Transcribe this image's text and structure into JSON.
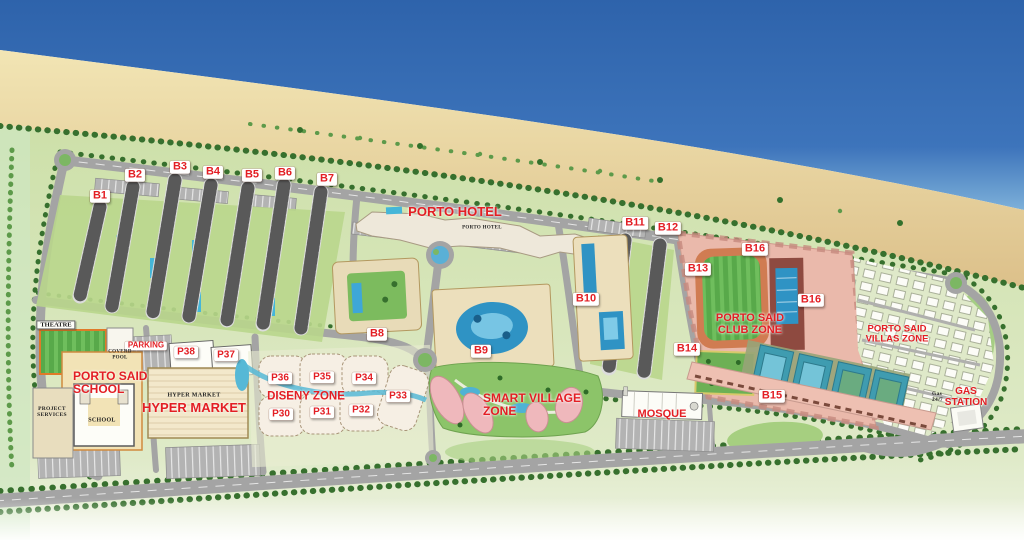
{
  "map": {
    "colors": {
      "sea_deep": "#2e63ab",
      "sea_shore": "#7db0d9",
      "sand_light": "#f2e5b4",
      "sand_dark": "#dcc08a",
      "land_green": "#cde0a9",
      "road_gray": "#a4a4a4",
      "label_red": "#e31e24",
      "chip_bg": "#ffffff",
      "pool_blue": "#2f93c4",
      "field_green": "#58a94a",
      "club_pink": "#eab9ab",
      "building_beige": "#ecdfbc",
      "tree_green": "#37702e"
    },
    "labels": [
      {
        "id": "b1",
        "style": "chip",
        "lines": [
          "B1"
        ],
        "x": 100,
        "y": 196,
        "size": 11
      },
      {
        "id": "b2",
        "style": "chip",
        "lines": [
          "B2"
        ],
        "x": 135,
        "y": 175,
        "size": 11
      },
      {
        "id": "b3",
        "style": "chip",
        "lines": [
          "B3"
        ],
        "x": 180,
        "y": 167,
        "size": 11
      },
      {
        "id": "b4",
        "style": "chip",
        "lines": [
          "B4"
        ],
        "x": 213,
        "y": 172,
        "size": 11
      },
      {
        "id": "b5",
        "style": "chip",
        "lines": [
          "B5"
        ],
        "x": 252,
        "y": 175,
        "size": 11
      },
      {
        "id": "b6",
        "style": "chip",
        "lines": [
          "B6"
        ],
        "x": 285,
        "y": 173,
        "size": 11
      },
      {
        "id": "b7",
        "style": "chip",
        "lines": [
          "B7"
        ],
        "x": 327,
        "y": 179,
        "size": 11
      },
      {
        "id": "b8",
        "style": "chip",
        "lines": [
          "B8"
        ],
        "x": 377,
        "y": 334,
        "size": 11
      },
      {
        "id": "b9",
        "style": "chip",
        "lines": [
          "B9"
        ],
        "x": 481,
        "y": 351,
        "size": 11
      },
      {
        "id": "b10",
        "style": "chip",
        "lines": [
          "B10"
        ],
        "x": 586,
        "y": 299,
        "size": 11
      },
      {
        "id": "b11",
        "style": "chip",
        "lines": [
          "B11"
        ],
        "x": 635,
        "y": 223,
        "size": 11
      },
      {
        "id": "b12",
        "style": "chip",
        "lines": [
          "B12"
        ],
        "x": 668,
        "y": 228,
        "size": 11
      },
      {
        "id": "b13",
        "style": "chip",
        "lines": [
          "B13"
        ],
        "x": 698,
        "y": 269,
        "size": 11
      },
      {
        "id": "b14",
        "style": "chip",
        "lines": [
          "B14"
        ],
        "x": 687,
        "y": 349,
        "size": 11
      },
      {
        "id": "b15",
        "style": "chip",
        "lines": [
          "B15"
        ],
        "x": 772,
        "y": 396,
        "size": 11
      },
      {
        "id": "b16-north",
        "style": "chip",
        "lines": [
          "B16"
        ],
        "x": 755,
        "y": 249,
        "size": 11
      },
      {
        "id": "b16-east",
        "style": "chip",
        "lines": [
          "B16"
        ],
        "x": 811,
        "y": 300,
        "size": 11
      },
      {
        "id": "p38",
        "style": "chip",
        "lines": [
          "P38"
        ],
        "x": 186,
        "y": 352,
        "size": 10
      },
      {
        "id": "p37",
        "style": "chip",
        "lines": [
          "P37"
        ],
        "x": 226,
        "y": 355,
        "size": 10
      },
      {
        "id": "p36",
        "style": "chip",
        "lines": [
          "P36"
        ],
        "x": 280,
        "y": 378,
        "size": 10
      },
      {
        "id": "p35",
        "style": "chip",
        "lines": [
          "P35"
        ],
        "x": 322,
        "y": 377,
        "size": 10
      },
      {
        "id": "p34",
        "style": "chip",
        "lines": [
          "P34"
        ],
        "x": 364,
        "y": 378,
        "size": 10
      },
      {
        "id": "p33",
        "style": "chip",
        "lines": [
          "P33"
        ],
        "x": 398,
        "y": 396,
        "size": 10
      },
      {
        "id": "p32",
        "style": "chip",
        "lines": [
          "P32"
        ],
        "x": 361,
        "y": 410,
        "size": 10
      },
      {
        "id": "p31",
        "style": "chip",
        "lines": [
          "P31"
        ],
        "x": 322,
        "y": 412,
        "size": 10
      },
      {
        "id": "p30",
        "style": "chip",
        "lines": [
          "P30"
        ],
        "x": 281,
        "y": 414,
        "size": 10
      },
      {
        "id": "parking",
        "style": "chip",
        "lines": [
          "PARKING"
        ],
        "x": 146,
        "y": 346,
        "size": 8
      },
      {
        "id": "porto-hotel",
        "style": "red",
        "lines": [
          "PORTO HOTEL"
        ],
        "x": 455,
        "y": 212,
        "size": 13
      },
      {
        "id": "porto-said-school",
        "style": "red",
        "align": "left",
        "lines": [
          "PORTO SAID",
          "SCHOOL"
        ],
        "x": 73,
        "y": 383,
        "size": 12
      },
      {
        "id": "hyper-market",
        "style": "red",
        "lines": [
          "HYPER MARKET"
        ],
        "x": 194,
        "y": 408,
        "size": 13
      },
      {
        "id": "diseny-zone",
        "style": "red",
        "lines": [
          "DISENY ZONE"
        ],
        "x": 306,
        "y": 397,
        "size": 11.5
      },
      {
        "id": "smart-village-zone",
        "style": "red",
        "align": "left",
        "lines": [
          "SMART VILLAGE",
          "ZONE"
        ],
        "x": 483,
        "y": 405,
        "size": 12
      },
      {
        "id": "porto-said-club-zone",
        "style": "red",
        "lines": [
          "PORTO SAID",
          "CLUB ZONE"
        ],
        "x": 750,
        "y": 324,
        "size": 11
      },
      {
        "id": "porto-said-villas-zone",
        "style": "red",
        "lines": [
          "PORTO SAID",
          "VILLAS ZONE"
        ],
        "x": 897,
        "y": 335,
        "size": 9.5
      },
      {
        "id": "mosque",
        "style": "red",
        "lines": [
          "MOSQUE"
        ],
        "x": 662,
        "y": 414,
        "size": 11
      },
      {
        "id": "gas-station",
        "style": "red",
        "lines": [
          "GAS",
          "STATION"
        ],
        "x": 966,
        "y": 397,
        "size": 10
      },
      {
        "id": "theatre",
        "style": "darkchip",
        "lines": [
          "THEATRE"
        ],
        "x": 56,
        "y": 325,
        "size": 6.5
      },
      {
        "id": "porto-hotel-building",
        "style": "dark",
        "lines": [
          "PORTO HOTEL"
        ],
        "x": 482,
        "y": 228,
        "size": 5
      },
      {
        "id": "coverd-pool",
        "style": "dark",
        "lines": [
          "COVERD",
          "POOL"
        ],
        "x": 120,
        "y": 355,
        "size": 5
      },
      {
        "id": "project-services",
        "style": "dark",
        "lines": [
          "PROJECT",
          "SERVICES"
        ],
        "x": 52,
        "y": 412,
        "size": 5.5
      },
      {
        "id": "school-building",
        "style": "dark",
        "lines": [
          "SCHOOL"
        ],
        "x": 102,
        "y": 421,
        "size": 6
      },
      {
        "id": "hyper-market-building",
        "style": "dark",
        "lines": [
          "HYPER MARKET"
        ],
        "x": 194,
        "y": 396,
        "size": 6
      },
      {
        "id": "gas-station-building",
        "style": "dark",
        "align": "left",
        "lines": [
          "Gas",
          "24/7"
        ],
        "x": 932,
        "y": 397,
        "size": 5.5
      }
    ]
  }
}
